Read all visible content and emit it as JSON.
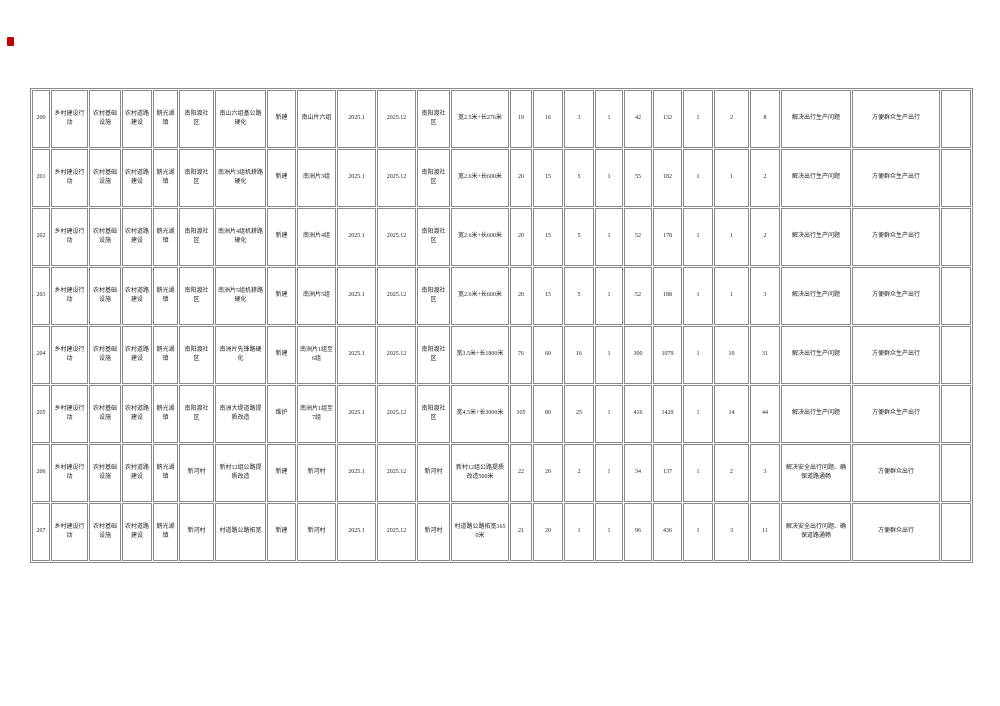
{
  "page": {
    "colors": {
      "grid": "#8a8a8a",
      "text": "#222222",
      "annotation_mark": "#c00000"
    }
  },
  "table": {
    "rows": [
      {
        "no": "200",
        "action": "乡村建设行动",
        "category": "农村基础设施",
        "sub": "农村道路建设",
        "town": "鹅光湖镇",
        "village": "南阳渡社区",
        "project": "南山六组基公路硬化",
        "type": "新建",
        "location": "南山片六组",
        "start": "2025.1",
        "end": "2025.12",
        "unit": "南阳渡社区",
        "scale": "宽2.5米+长276米",
        "nums": [
          "19",
          "16",
          "3",
          "1",
          "42",
          "132",
          "1",
          "2",
          "8"
        ],
        "purpose": "解决出行生产问题",
        "effect": "方便群众生产出行",
        "blank": ""
      },
      {
        "no": "201",
        "action": "乡村建设行动",
        "category": "农村基础设施",
        "sub": "农村道路建设",
        "town": "鹅光湖镇",
        "village": "南阳渡社区",
        "project": "南洲片3组机耕路硬化",
        "type": "新建",
        "location": "南洲片3组",
        "start": "2025.1",
        "end": "2025.12",
        "unit": "南阳渡社区",
        "scale": "宽2.6米+长600米",
        "nums": [
          "20",
          "15",
          "5",
          "1",
          "55",
          "182",
          "1",
          "1",
          "2"
        ],
        "purpose": "解决出行生产问题",
        "effect": "方便群众生产出行",
        "blank": ""
      },
      {
        "no": "202",
        "action": "乡村建设行动",
        "category": "农村基础设施",
        "sub": "农村道路建设",
        "town": "鹅光湖镇",
        "village": "南阳渡社区",
        "project": "南洲片4组机耕路硬化",
        "type": "新建",
        "location": "南洲片4组",
        "start": "2025.1",
        "end": "2025.12",
        "unit": "南阳渡社区",
        "scale": "宽2.6米+长600米",
        "nums": [
          "20",
          "15",
          "5",
          "1",
          "52",
          "178",
          "1",
          "1",
          "2"
        ],
        "purpose": "解决出行生产问题",
        "effect": "方便群众生产出行",
        "blank": ""
      },
      {
        "no": "203",
        "action": "乡村建设行动",
        "category": "农村基础设施",
        "sub": "农村道路建设",
        "town": "鹅光湖镇",
        "village": "南阳渡社区",
        "project": "南洲片5组机耕路硬化",
        "type": "新建",
        "location": "南洲片5组",
        "start": "2025.1",
        "end": "2025.12",
        "unit": "南阳渡社区",
        "scale": "宽2.6米+长600米",
        "nums": [
          "20",
          "15",
          "5",
          "1",
          "52",
          "188",
          "1",
          "1",
          "3"
        ],
        "purpose": "解决出行生产问题",
        "effect": "方便群众生产出行",
        "blank": ""
      },
      {
        "no": "204",
        "action": "乡村建设行动",
        "category": "农村基础设施",
        "sub": "农村道路建设",
        "town": "鹅光湖镇",
        "village": "南阳渡社区",
        "project": "南洲片先锋路硬化",
        "type": "新建",
        "location": "南洲片1组至6组",
        "start": "2025.1",
        "end": "2025.12",
        "unit": "南阳渡社区",
        "scale": "宽3.5米+长1800米",
        "nums": [
          "76",
          "60",
          "16",
          "1",
          "300",
          "1079",
          "1",
          "10",
          "31"
        ],
        "purpose": "解决出行生产问题",
        "effect": "方便群众生产出行",
        "blank": ""
      },
      {
        "no": "205",
        "action": "乡村建设行动",
        "category": "农村基础设施",
        "sub": "农村道路建设",
        "town": "鹅光湖镇",
        "village": "南阳渡社区",
        "project": "南洲大堤道路提质改造",
        "type": "维护",
        "location": "南洲片1组至7组",
        "start": "2025.1",
        "end": "2025.12",
        "unit": "南阳渡社区",
        "scale": "宽4.5米+长3000米",
        "nums": [
          "105",
          "80",
          "25",
          "1",
          "416",
          "1420",
          "1",
          "14",
          "44"
        ],
        "purpose": "解决出行生产问题",
        "effect": "方便群众生产出行",
        "blank": ""
      },
      {
        "no": "206",
        "action": "乡村建设行动",
        "category": "农村基础设施",
        "sub": "农村道路建设",
        "town": "鹅光湖镇",
        "village": "新河村",
        "project": "新村12组公路提质改造",
        "type": "新建",
        "location": "新河村",
        "start": "2025.1",
        "end": "2025.12",
        "unit": "新河村",
        "scale": "新村12组公路提质改造500米",
        "nums": [
          "22",
          "20",
          "2",
          "1",
          "34",
          "137",
          "1",
          "2",
          "3"
        ],
        "purpose": "解决安全出行问题、确保道路通畅",
        "effect": "方便群众出行",
        "blank": ""
      },
      {
        "no": "207",
        "action": "乡村建设行动",
        "category": "农村基础设施",
        "sub": "农村道路建设",
        "town": "鹅光湖镇",
        "village": "新河村",
        "project": "村道路公路拓宽",
        "type": "新建",
        "location": "新河村",
        "start": "2025.1",
        "end": "2025.12",
        "unit": "新河村",
        "scale": "村道路公路拓宽1650米",
        "nums": [
          "21",
          "20",
          "1",
          "1",
          "96",
          "436",
          "1",
          "3",
          "11"
        ],
        "purpose": "解决安全出行问题、确保道路通畅",
        "effect": "方便群众出行",
        "blank": ""
      }
    ]
  }
}
